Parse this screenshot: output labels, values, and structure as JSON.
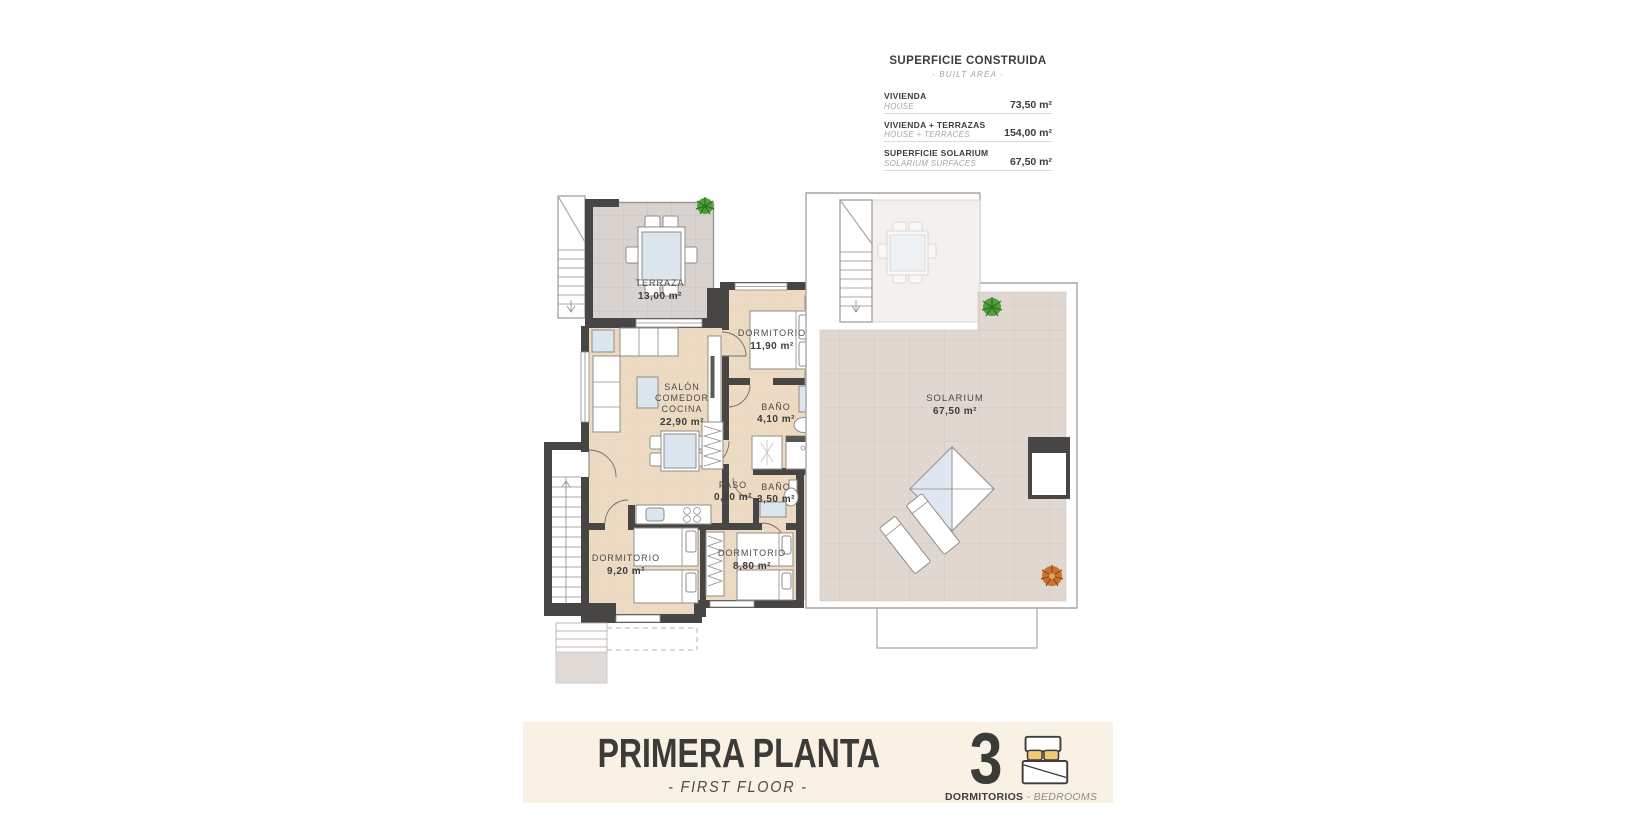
{
  "built_area_panel": {
    "title": "SUPERFICIE CONSTRUIDA",
    "subtitle": "- BUILT AREA -",
    "rows": [
      {
        "es": "VIVIENDA",
        "en": "HOUSE",
        "value": "73,50 m²"
      },
      {
        "es": "VIVIENDA + TERRAZAS",
        "en": "HOUSE + TERRACES",
        "value": "154,00 m²"
      },
      {
        "es": "SUPERFICIE SOLARIUM",
        "en": "SOLARIUM SURFACES",
        "value": "67,50 m²"
      }
    ]
  },
  "floor_plan": {
    "rooms": {
      "terraza": {
        "name": "TERRAZA",
        "area": "13,00 m²"
      },
      "salon": {
        "l1": "SALÓN",
        "l2": "COMEDOR",
        "l3": "COCINA",
        "area": "22,90 m²"
      },
      "dorm1": {
        "name": "DORMITORIO",
        "area": "11,90 m²"
      },
      "bath1": {
        "name": "BAÑO",
        "area": "4,10 m²"
      },
      "paso": {
        "name": "PASO",
        "area": "0,90 m²"
      },
      "bath2": {
        "name": "BAÑO",
        "area": "3,50 m²"
      },
      "dorm2": {
        "name": "DORMITORIO",
        "area": "9,20 m²"
      },
      "dorm3": {
        "name": "DORMITORIO",
        "area": "8,80 m²"
      },
      "solarium": {
        "name": "SOLARIUM",
        "area": "67,50 m²"
      }
    }
  },
  "banner": {
    "title": "PRIMERA PLANTA",
    "subtitle": "- FIRST FLOOR -",
    "bedrooms_count": "3",
    "bedrooms_label_es": "DORMITORIOS",
    "bedrooms_label_en": " - BEDROOMS"
  },
  "colors": {
    "wall": "#474645",
    "floor_beige": "#ecdbc2",
    "terrace_tile": "#d9d3cf",
    "solarium_tile": "#e0d7d1",
    "banner_bg": "#f8f1e4",
    "pillow_yellow": "#f0ca73",
    "plant_green": "#4f9f3a",
    "plant_orange": "#c8742f",
    "text_dark": "#3d3d3c"
  }
}
